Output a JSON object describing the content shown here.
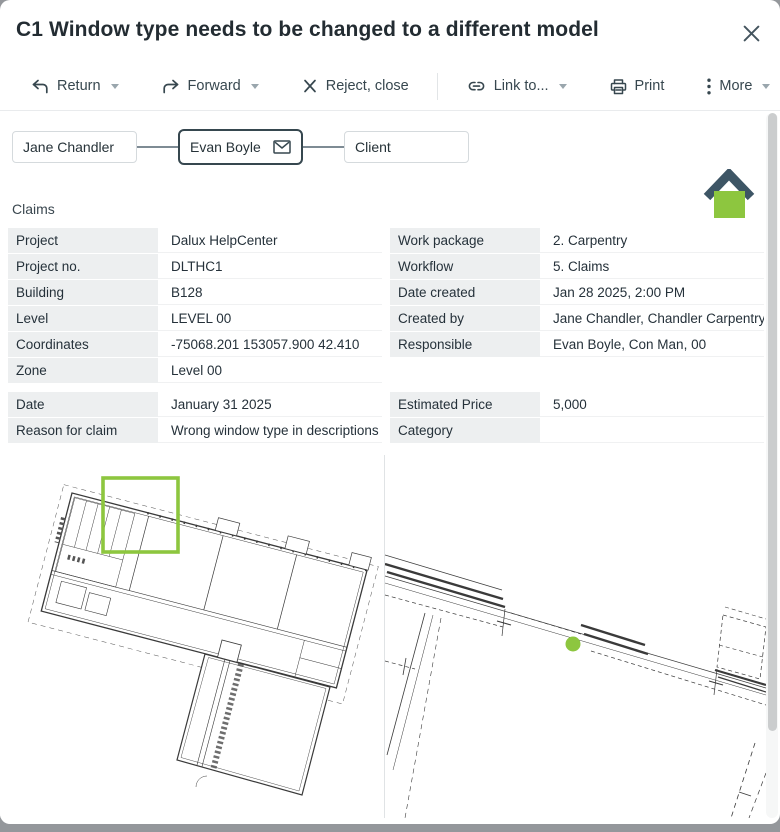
{
  "header": {
    "title": "C1 Window type needs to be changed to a different model"
  },
  "toolbar": {
    "return": "Return",
    "forward": "Forward",
    "reject": "Reject, close",
    "link": "Link to...",
    "print": "Print",
    "more": "More"
  },
  "workflow": {
    "steps": [
      {
        "label": "Jane Chandler"
      },
      {
        "label": "Evan Boyle"
      },
      {
        "label": "Client"
      }
    ]
  },
  "section": {
    "label": "Claims"
  },
  "details": {
    "left": [
      {
        "label": "Project",
        "value": "Dalux HelpCenter"
      },
      {
        "label": "Project no.",
        "value": "DLTHC1"
      },
      {
        "label": "Building",
        "value": "B128"
      },
      {
        "label": "Level",
        "value": "LEVEL 00"
      },
      {
        "label": "Coordinates",
        "value": "-75068.201 153057.900 42.410"
      },
      {
        "label": "Zone",
        "value": "Level 00"
      }
    ],
    "right": [
      {
        "label": "Work package",
        "value": "2. Carpentry"
      },
      {
        "label": "Workflow",
        "value": "5. Claims"
      },
      {
        "label": "Date created",
        "value": "Jan 28 2025, 2:00 PM"
      },
      {
        "label": "Created by",
        "value": "Jane Chandler, Chandler Carpentry"
      },
      {
        "label": "Responsible",
        "value": "Evan Boyle, Con Man, 00"
      }
    ]
  },
  "claim": {
    "left": [
      {
        "label": "Date",
        "value": "January 31 2025"
      },
      {
        "label": "Reason for claim",
        "value": "Wrong window type in descriptions"
      }
    ],
    "right": [
      {
        "label": "Estimated Price",
        "value": "5,000"
      },
      {
        "label": "Category",
        "value": ""
      }
    ]
  },
  "colors": {
    "green": "#8dc63f",
    "slate": "#3d5565"
  }
}
